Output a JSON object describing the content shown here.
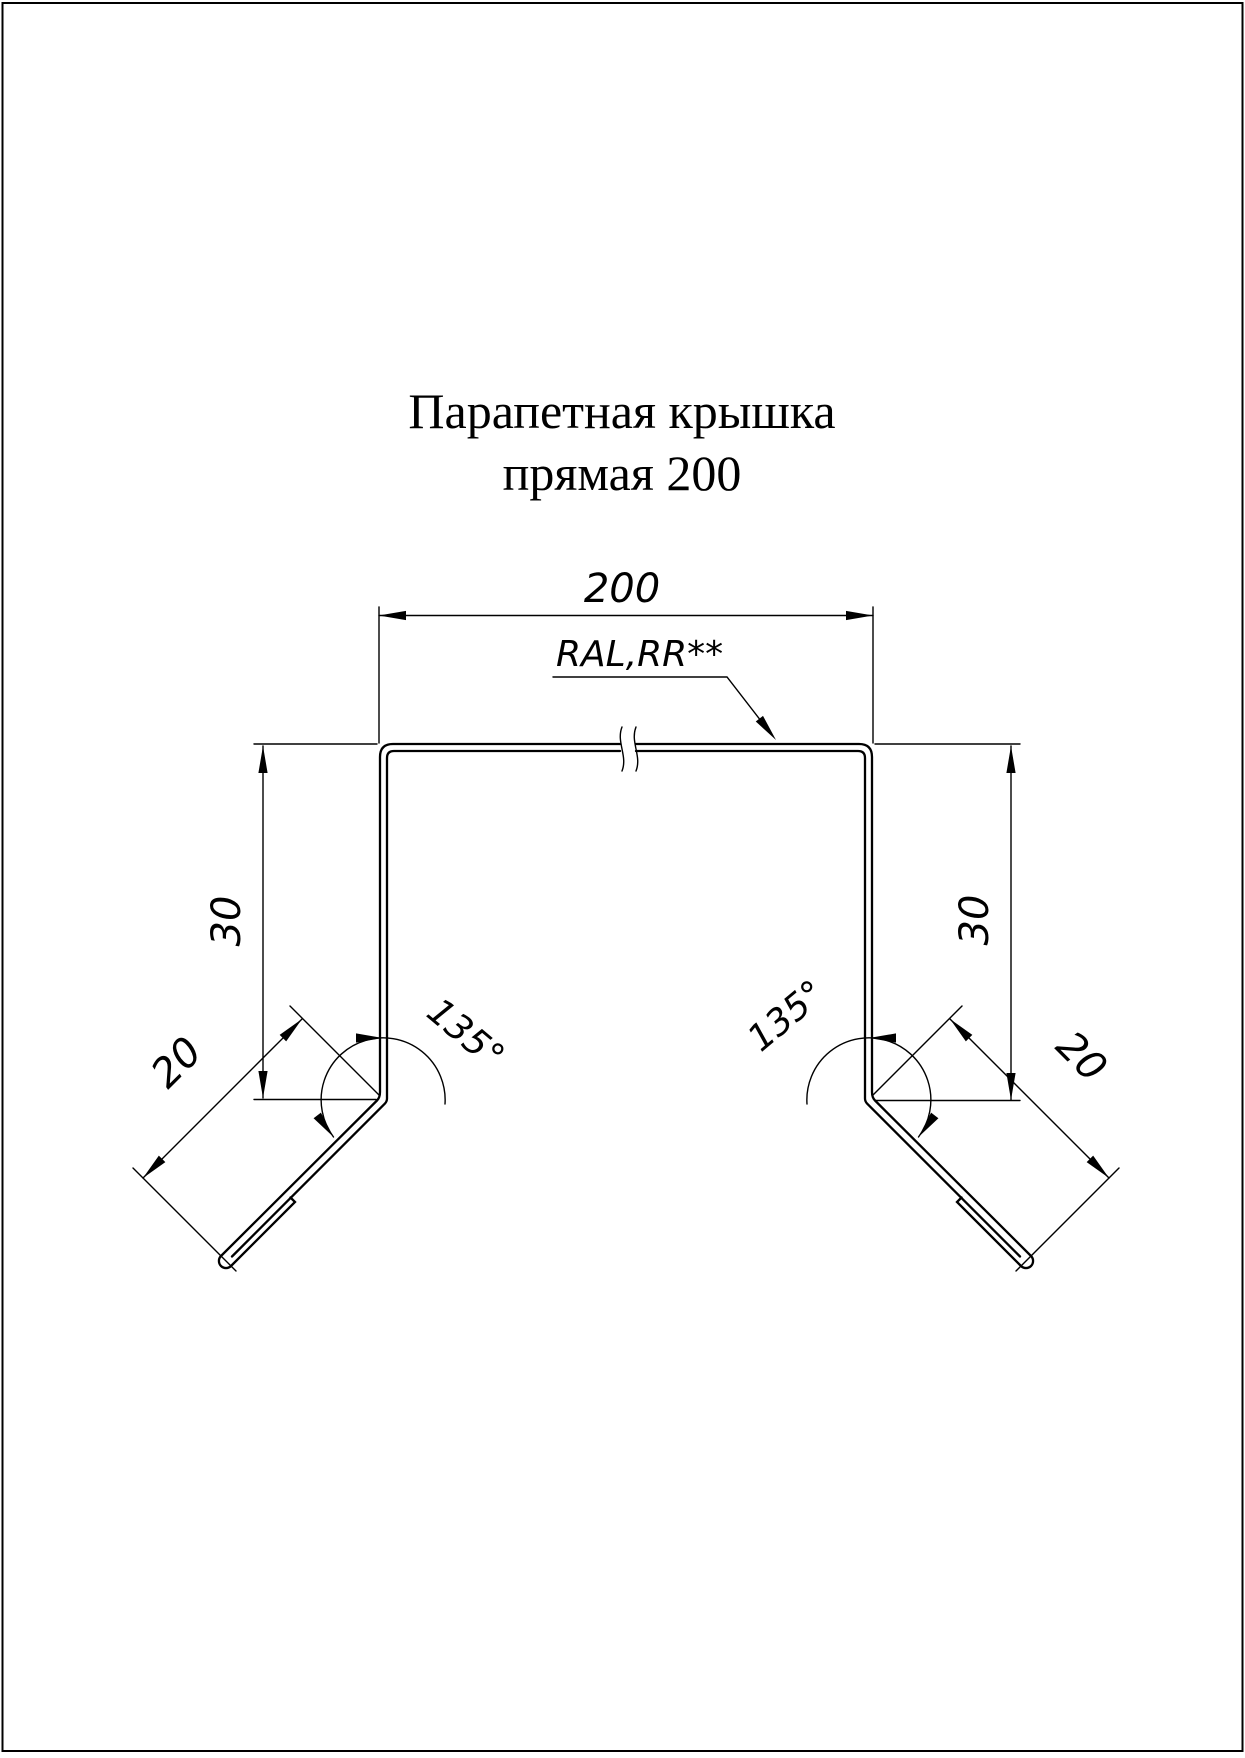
{
  "drawing": {
    "title_line1": "Парапетная крышка",
    "title_line2": "прямая 200",
    "labels": {
      "top_width": "200",
      "coating": "RAL,RR**",
      "left_height": "30",
      "right_height": "30",
      "left_angle": "135°",
      "right_angle": "135°",
      "left_hem": "20",
      "right_hem": "20"
    },
    "colors": {
      "line": "#000000",
      "background": "#ffffff"
    }
  }
}
